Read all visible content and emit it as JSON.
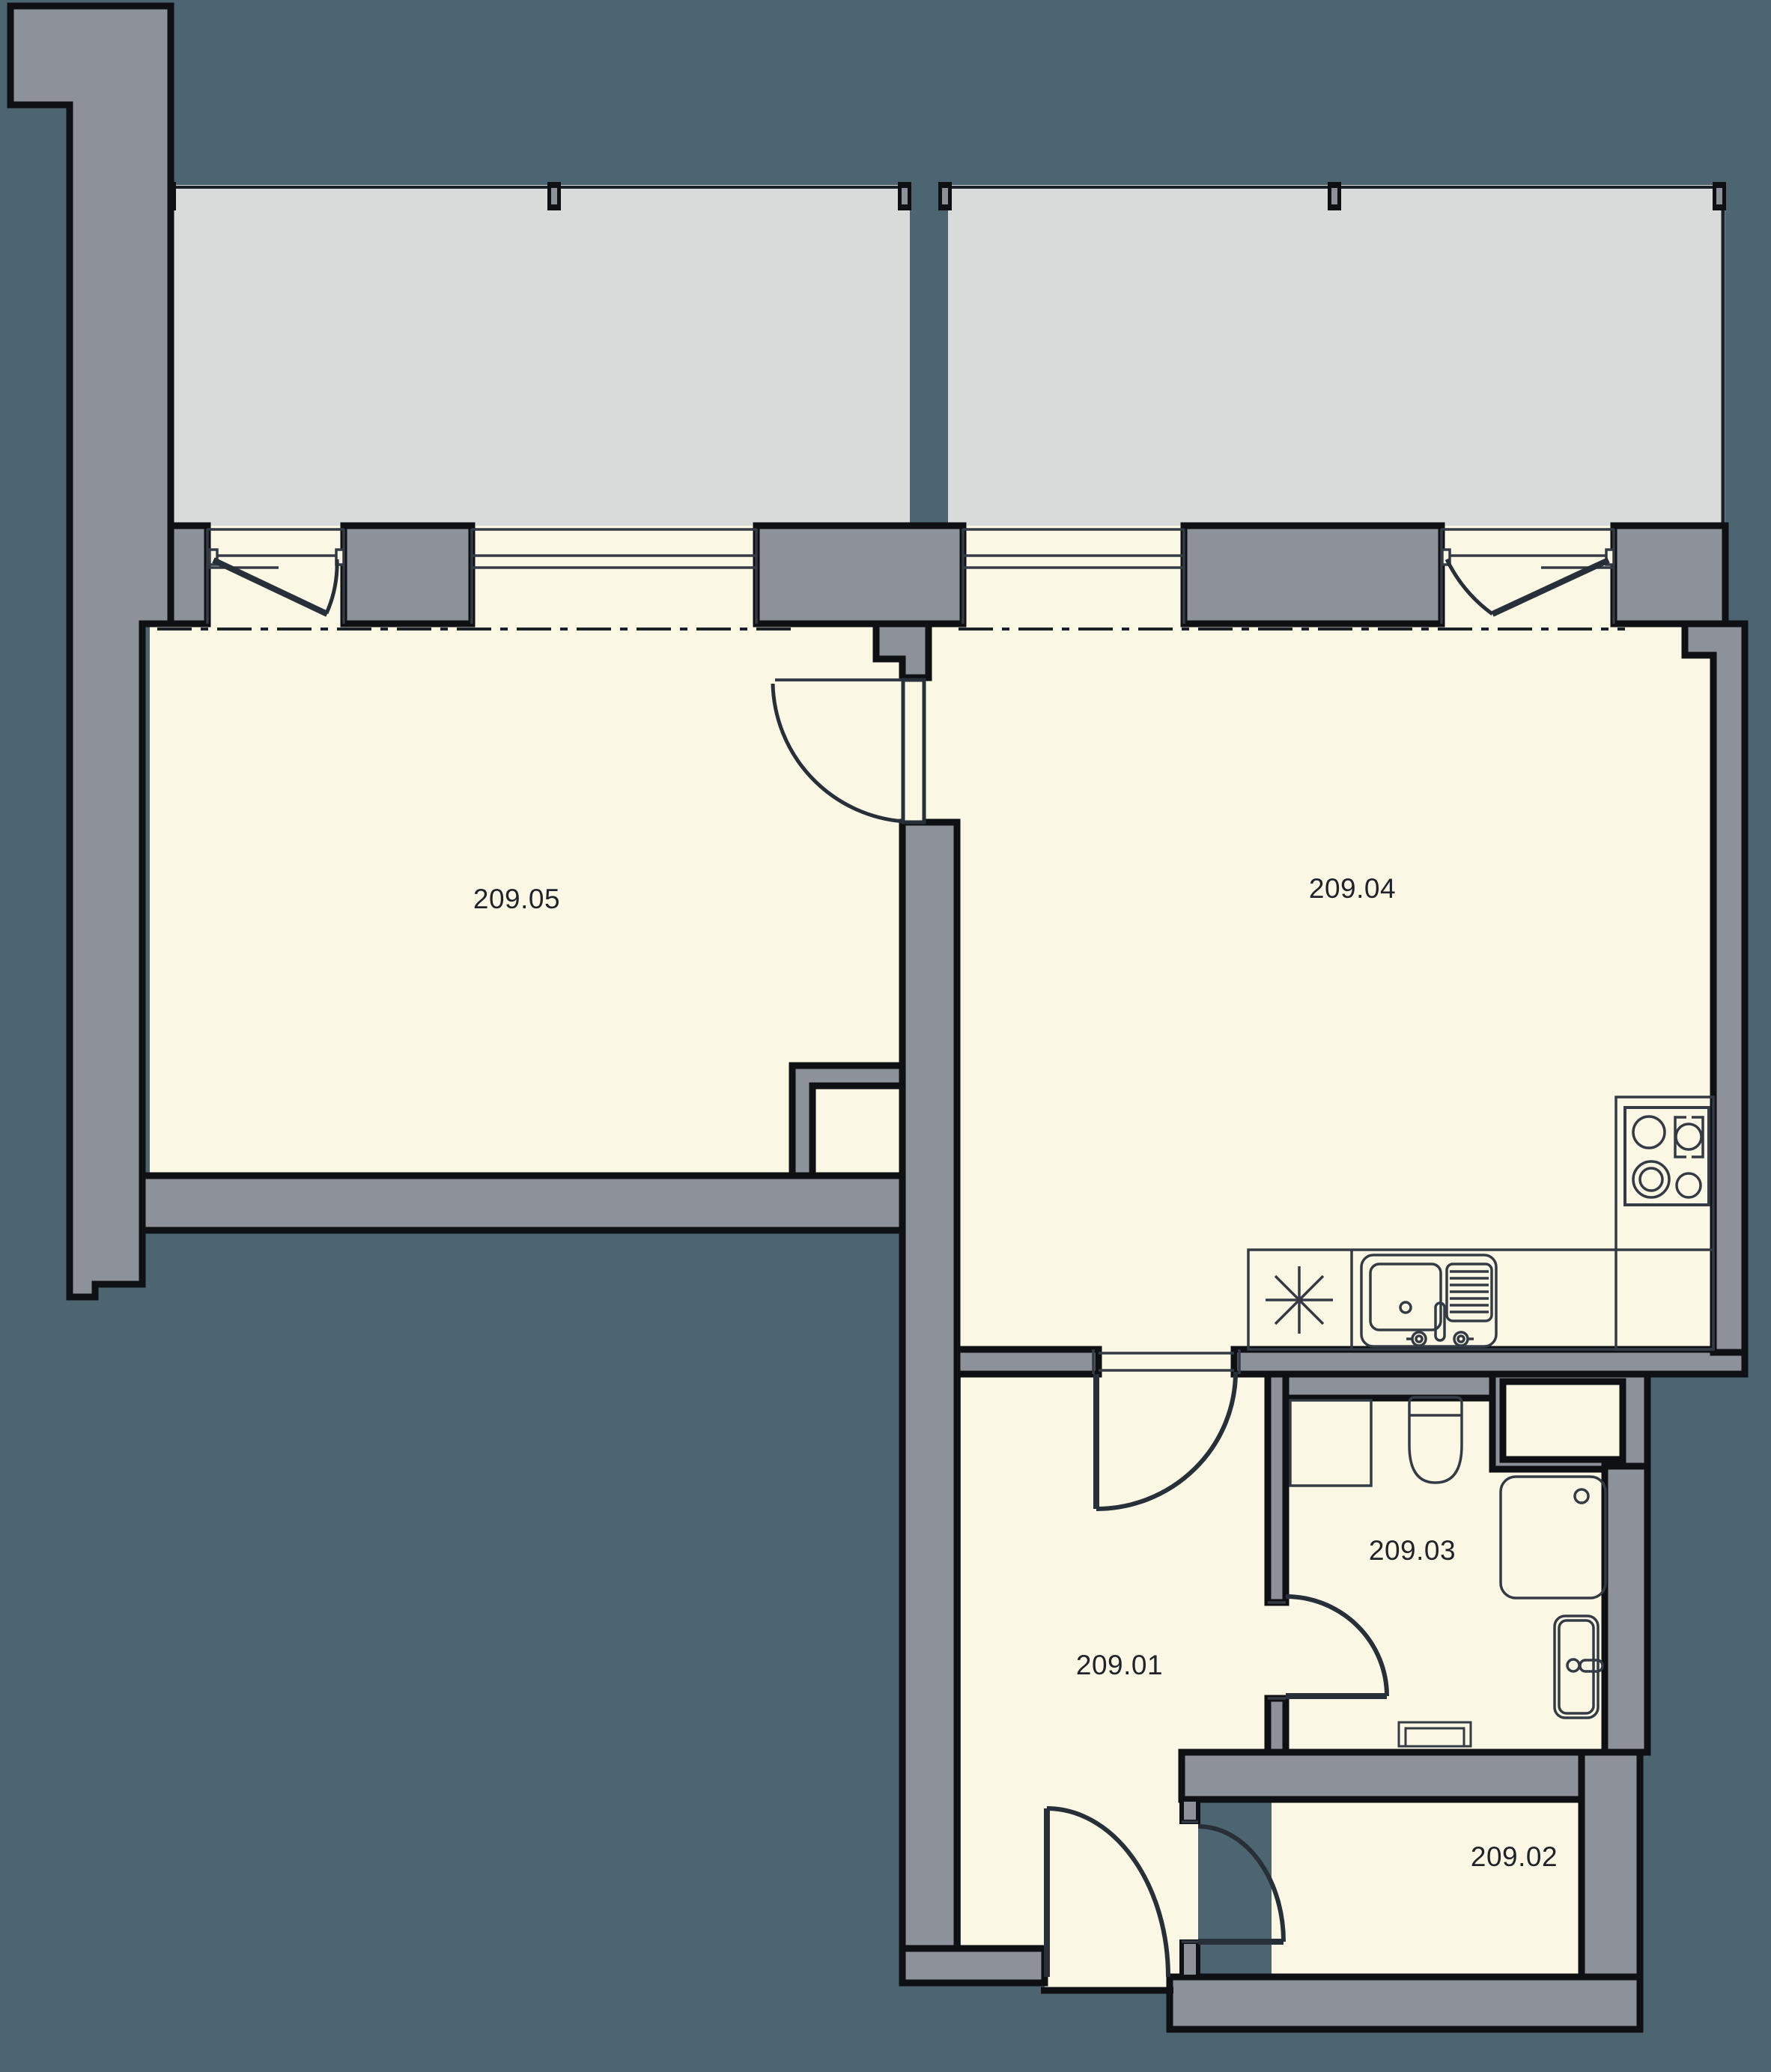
{
  "rooms": [
    {
      "number": "209.01",
      "type": "hall"
    },
    {
      "number": "209.02",
      "type": "storage-room"
    },
    {
      "number": "209.03",
      "type": "bathroom"
    },
    {
      "number": "209.04",
      "type": "living-room-kitchen"
    },
    {
      "number": "209.05",
      "type": "bedroom"
    }
  ],
  "colors": {
    "background": "#4d6570",
    "wall": "#8d9199",
    "outline": "#0e1013",
    "room": "#fbf7e5",
    "balcony": "#d9dbdb",
    "detail": "#343b44",
    "door": "#272f38",
    "axis": "#1c2127",
    "text": "#20242a"
  },
  "fixtures": {
    "cooktop": "cooktop-icon",
    "kitchen_sink": "kitchen-sink-icon",
    "dishwasher_symbol": "dishwasher-symbol-icon",
    "toilet": "toilet-icon",
    "shower": "shower-icon",
    "washbasin": "washbasin-icon",
    "washing_machine": "washing-machine-icon",
    "radiator": "radiator-icon"
  }
}
